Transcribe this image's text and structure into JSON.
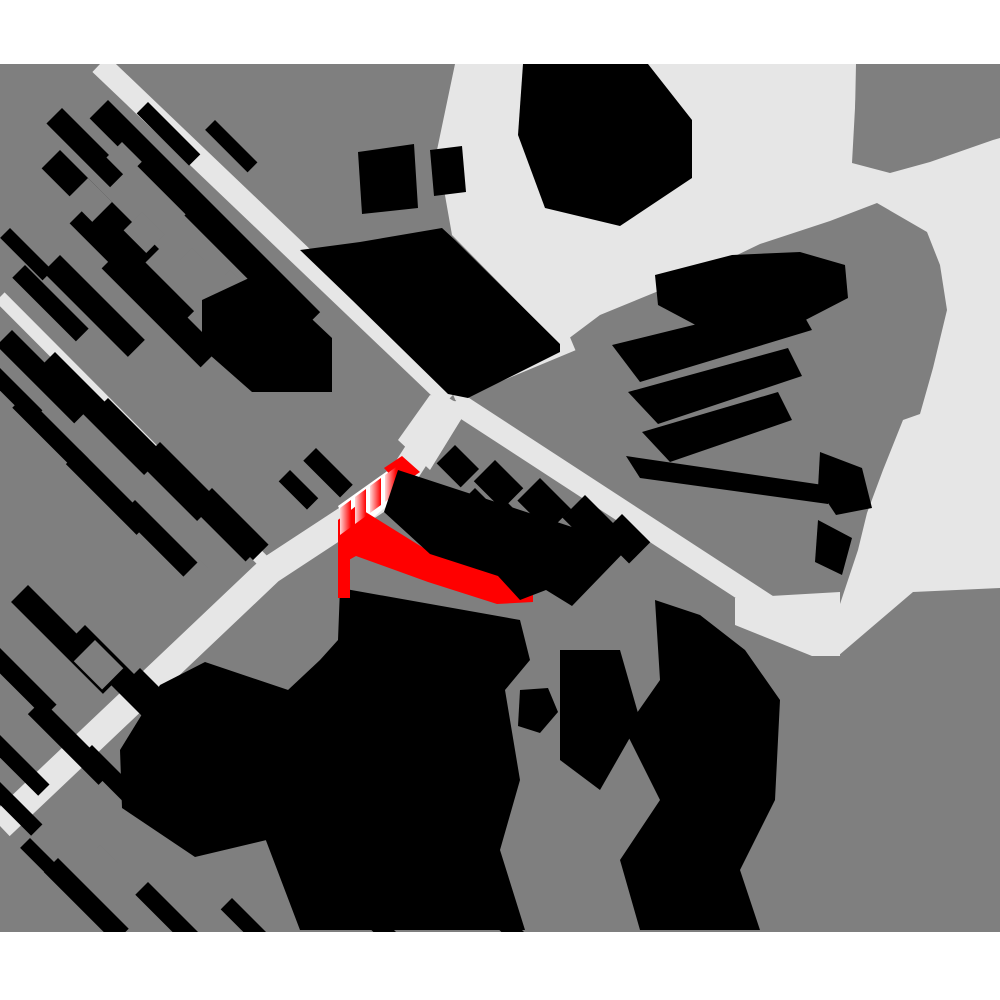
{
  "meta": {
    "type": "axonometric-city-map",
    "description": "Monochrome 2.5D figure-ground site map: gray ground plane, light roads and plazas, black extruded buildings, one building highlighted in red near the center junction",
    "visible_text": "",
    "highlighted_feature": "selected-building-red"
  },
  "colors": {
    "background": "#ffffff",
    "ground": "#7f7f7f",
    "road": "#e6e6e6",
    "building": "#000000",
    "highlight_red": "#ff0000",
    "highlight_light": "#ffd6d6",
    "white": "#ffffff"
  },
  "canvas": {
    "width": 1000,
    "height": 1000,
    "map_top": 64,
    "map_height": 868
  },
  "map": {
    "ground": {
      "x": 0,
      "y": 64,
      "w": 1000,
      "h": 868
    },
    "light_areas": [
      {
        "name": "plaza-and-east-boulevard",
        "points": "455,64 856,64 856,90 852,163 890,173 930,162 993,140 1000,138 1000,588 913,592 838,656 812,656 790,628 838,610 858,550 867,513 883,470 903,420 920,414 933,368 947,310 940,265 927,232 877,203 830,221 760,244 683,281 600,315 560,345 452,235 437,150"
      },
      {
        "name": "road5-end-funnel",
        "points": "735,598 840,592 840,656 812,656 735,625"
      },
      {
        "name": "junction-flare",
        "points": "430,395 470,405 430,470 398,440"
      }
    ],
    "gray_overlays": [
      {
        "name": "topright-corner-block",
        "points": "856,64 1000,64 1000,136 992,138 928,160 888,171 854,161"
      }
    ],
    "roads": [
      {
        "name": "road-northwest-diagonal",
        "points": "100,64 450,398",
        "width": 22
      },
      {
        "name": "road-southwest-diagonal",
        "points": "452,400 395,488 270,570 0,826",
        "width": 28
      },
      {
        "name": "road-left-narrow",
        "points": "0,297 270,568",
        "width": 13
      },
      {
        "name": "road-northeast-connector",
        "points": "452,392 572,342",
        "width": 18
      },
      {
        "name": "road-southeast-diagonal",
        "points": "455,402 805,630",
        "width": 22
      }
    ],
    "building_rows": [
      {
        "cluster": "northwest-block",
        "items": [
          [
            108,
            100,
            300,
            26
          ],
          [
            62,
            108,
            90,
            22
          ],
          [
            60,
            150,
            140,
            26
          ],
          [
            88,
            205,
            150,
            26
          ],
          [
            60,
            255,
            120,
            24
          ],
          [
            120,
            250,
            140,
            26
          ],
          [
            25,
            265,
            90,
            18
          ],
          [
            10,
            228,
            60,
            14
          ],
          [
            160,
            160,
            80,
            20
          ],
          [
            200,
            200,
            90,
            22
          ],
          [
            148,
            102,
            74,
            16
          ],
          [
            215,
            120,
            60,
            14
          ]
        ]
      },
      {
        "cluster": "southwest-block",
        "items": [
          [
            12,
            330,
            110,
            22
          ],
          [
            55,
            352,
            150,
            24
          ],
          [
            108,
            398,
            150,
            24
          ],
          [
            160,
            442,
            145,
            24
          ],
          [
            212,
            488,
            80,
            22
          ],
          [
            25,
            395,
            90,
            18
          ],
          [
            80,
            450,
            100,
            20
          ],
          [
            135,
            500,
            90,
            20
          ],
          [
            0,
            368,
            60,
            16
          ],
          [
            316,
            448,
            52,
            18
          ],
          [
            290,
            470,
            40,
            16
          ]
        ]
      },
      {
        "cluster": "south-block",
        "items": [
          [
            28,
            585,
            130,
            24
          ],
          [
            85,
            625,
            140,
            24
          ],
          [
            0,
            648,
            80,
            18
          ],
          [
            140,
            668,
            130,
            22
          ],
          [
            42,
            700,
            100,
            20
          ],
          [
            190,
            712,
            110,
            20
          ],
          [
            0,
            735,
            70,
            16
          ],
          [
            245,
            755,
            100,
            20
          ],
          [
            92,
            745,
            90,
            18
          ],
          [
            58,
            858,
            100,
            20
          ],
          [
            148,
            882,
            90,
            18
          ],
          [
            232,
            898,
            80,
            16
          ],
          [
            348,
            884,
            80,
            16
          ],
          [
            480,
            888,
            70,
            16
          ],
          [
            0,
            782,
            60,
            16
          ],
          [
            30,
            838,
            60,
            14
          ]
        ]
      },
      {
        "cluster": "east-checker-block",
        "items": [
          [
            455,
            445,
            34,
            26
          ],
          [
            495,
            460,
            40,
            30
          ],
          [
            540,
            478,
            44,
            32
          ],
          [
            585,
            495,
            44,
            32
          ],
          [
            622,
            514,
            40,
            30
          ],
          [
            505,
            500,
            34,
            26
          ],
          [
            552,
            520,
            36,
            26
          ],
          [
            475,
            488,
            28,
            22
          ]
        ]
      }
    ],
    "courtyards": [
      [
        88,
        178,
        34,
        28
      ],
      [
        142,
        212,
        32,
        26
      ],
      [
        192,
        248,
        30,
        24
      ],
      [
        122,
        142,
        28,
        22
      ],
      [
        230,
        270,
        34,
        28
      ],
      [
        95,
        640,
        40,
        30
      ],
      [
        100,
        845,
        26,
        22
      ],
      [
        200,
        560,
        30,
        24
      ]
    ],
    "buildings": [
      {
        "name": "top-plaza-building",
        "points": "523,64 648,64 692,120 692,178 620,226 545,208 518,135"
      },
      {
        "name": "central-north-block",
        "points": "300,250 360,242 442,228 455,240 560,344 560,352 468,398 448,394 352,300"
      },
      {
        "name": "north-small-1",
        "points": "358,152 414,144 418,208 362,214"
      },
      {
        "name": "north-small-2",
        "points": "430,150 462,146 466,192 434,196"
      },
      {
        "name": "northwest-large",
        "points": "202,300 262,272 332,338 332,392 252,392 202,348"
      },
      {
        "name": "leaf-cluster-1",
        "points": "655,275 732,255 800,252 845,265 848,298 790,328 705,330 658,305"
      },
      {
        "name": "leaf-cluster-2",
        "points": "612,345 795,300 812,330 640,382"
      },
      {
        "name": "leaf-cluster-3",
        "points": "628,392 788,348 802,376 658,424"
      },
      {
        "name": "leaf-cluster-4",
        "points": "642,432 778,392 792,420 670,462"
      },
      {
        "name": "leaf-bottom-band",
        "points": "626,456 830,486 828,504 640,478"
      },
      {
        "name": "right-edge-1",
        "points": "820,452 862,468 872,508 836,515 818,488"
      },
      {
        "name": "right-edge-2",
        "points": "818,520 852,538 842,575 815,562"
      },
      {
        "name": "south-blob",
        "points": "340,588 520,620 530,660 505,690 520,780 500,850 525,930 300,930 262,830 295,750 272,705 320,660 338,640"
      },
      {
        "name": "south-left-blob",
        "points": "160,685 205,662 312,698 348,760 300,832 195,857 122,808 120,750"
      },
      {
        "name": "south-col-1",
        "points": "560,650 620,650 640,720 600,790 560,760"
      },
      {
        "name": "south-col-2",
        "points": "655,600 700,615 745,650 780,700 775,800 740,870 760,930 640,930 620,860 660,800 625,730 660,680"
      },
      {
        "name": "south-dot",
        "points": "520,690 548,688 558,712 540,733 518,726"
      }
    ],
    "highlight": {
      "name": "selected-building-red",
      "white_underlay": "338,506 400,462 403,492 352,536",
      "stripe_bars": [
        [
          340,
          508
        ],
        [
          355,
          497
        ],
        [
          370,
          486
        ],
        [
          385,
          475
        ]
      ],
      "stripe_w": 11,
      "stripe_rise": 8,
      "stripe_drop": 19,
      "stripe_down": 27,
      "red_shapes": [
        {
          "name": "red-roof-strip",
          "points": "384,468 402,456 420,472 400,486"
        },
        {
          "name": "red-main-band",
          "points": "338,520 356,506 430,552 498,576 520,560 533,572 533,602 497,604 428,582 356,556 338,566"
        },
        {
          "name": "red-east-wedge",
          "points": "497,518 533,546 533,602 490,600 478,575"
        },
        {
          "name": "red-west-strip",
          "points": "338,520 350,512 350,598 338,598"
        }
      ],
      "black_overlay": "398,470 630,546 572,606 546,590 520,600 498,576 430,554 384,512"
    }
  }
}
